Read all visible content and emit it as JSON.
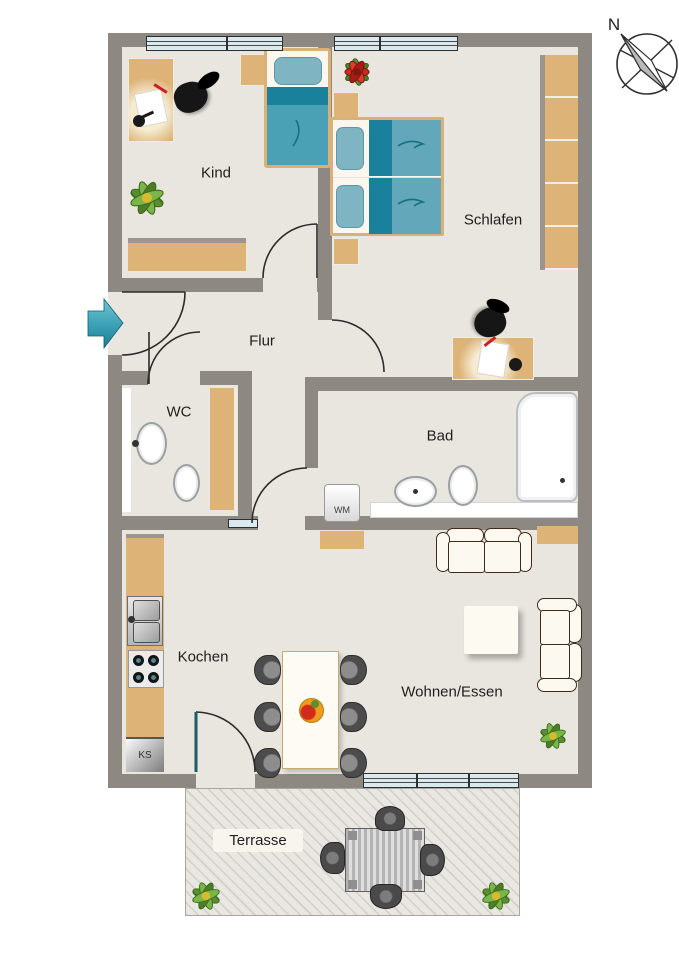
{
  "floorplan": {
    "compass_label": "N",
    "rooms": {
      "kind": "Kind",
      "schlafen": "Schlafen",
      "flur": "Flur",
      "wc": "WC",
      "bad": "Bad",
      "kochen": "Kochen",
      "wohnen_essen": "Wohnen/Essen",
      "terrasse": "Terrasse"
    },
    "appliances": {
      "washing_machine": "WM",
      "fridge": "KS"
    },
    "colors": {
      "wall": "#8E8882",
      "floor": "#E9E6DF",
      "furniture_wood": "#DDB377",
      "bed_dark_teal": "#19819B",
      "bed_light_teal": "#62A8BA",
      "bed_single_teal": "#4AA0B5",
      "bed_pillow": "#7FB5C3",
      "window_glass": "#D9E9ED",
      "entrance_arrow": "#2E9FB5",
      "terrace_floor": "#E9E7E2",
      "chair_dark": "#4A4A4A"
    }
  }
}
